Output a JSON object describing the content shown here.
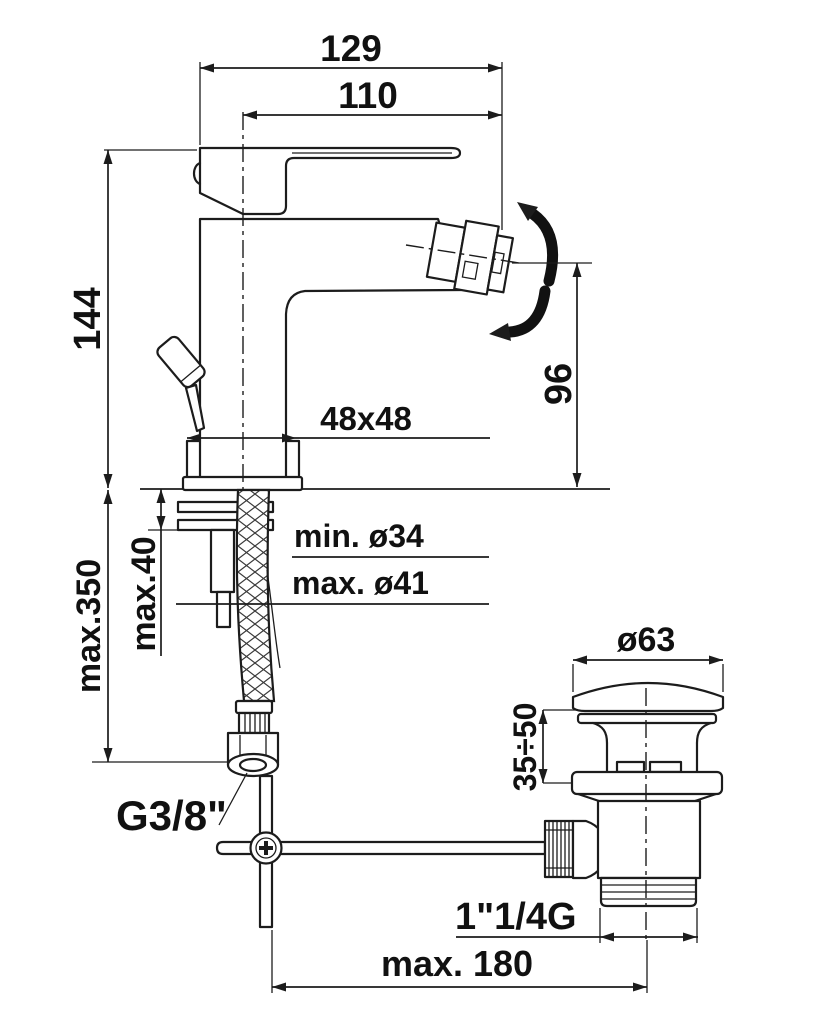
{
  "meta": {
    "type": "technical-dimensional-drawing",
    "subject": "single-lever bidet mixer with swivel spray nozzle, flexible supply hose and pop-up waste"
  },
  "colors": {
    "background": "#ffffff",
    "line": "#1c1c1c",
    "text": "#111111"
  },
  "labels": {
    "width_total": "129",
    "spout_projection": "110",
    "height_to_lever": "144",
    "nozzle_to_deck": "96",
    "base_footprint": "48x48",
    "hole_min": "min. ø34",
    "hole_max": "max. ø41",
    "deck_thickness": "max.40",
    "hose_length": "max.350",
    "supply_connection": "G3/8\"",
    "waste_cap_diameter": "ø63",
    "waste_height_range": "35÷50",
    "waste_thread": "1\"1/4G",
    "rod_to_waste_distance": "max. 180"
  }
}
